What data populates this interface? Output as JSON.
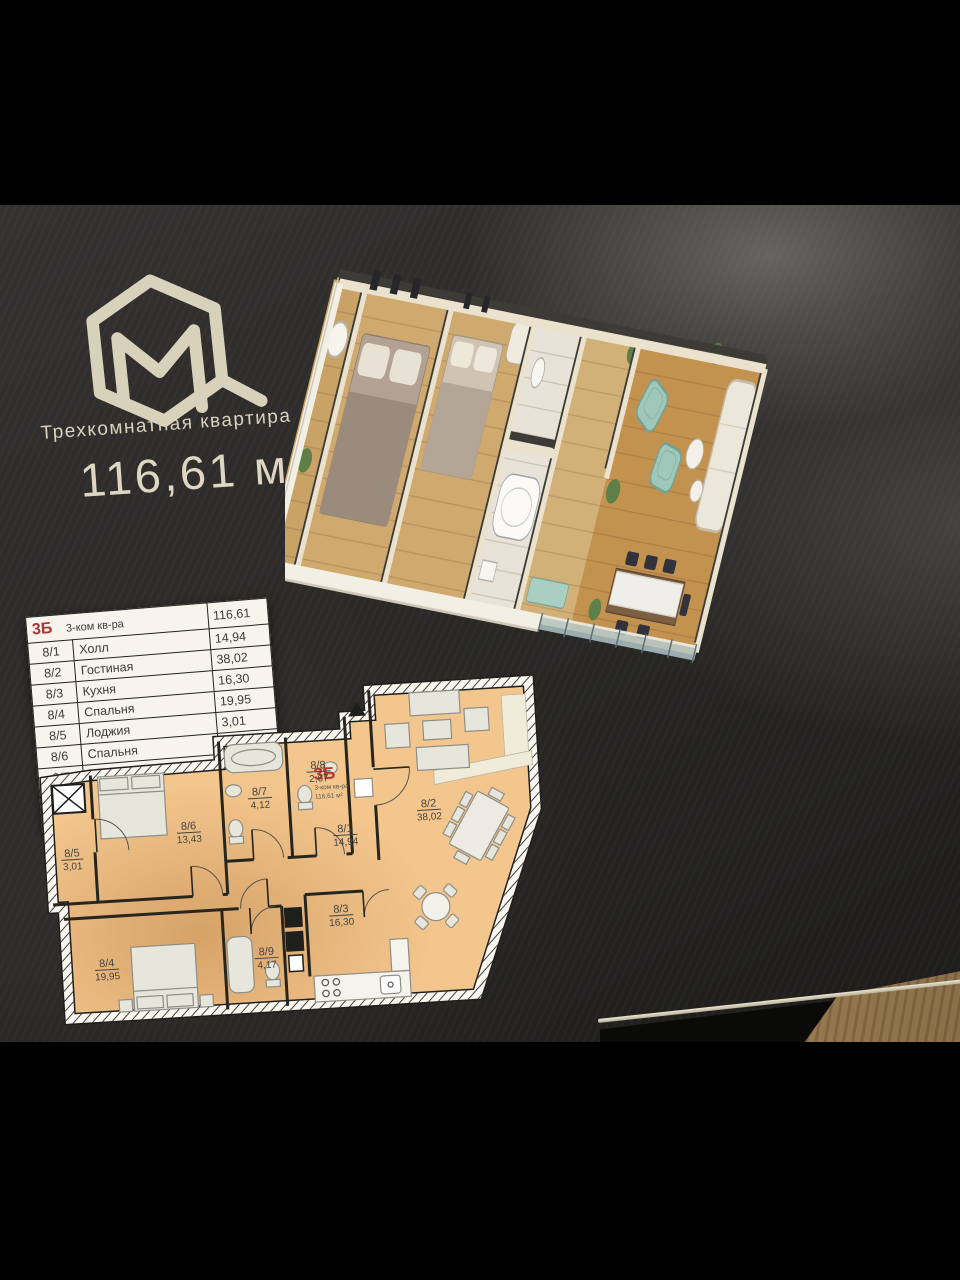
{
  "brand": {
    "mark": "М"
  },
  "header": {
    "subtitle": "Трехкомнатная квартира",
    "area": "116,61 м2"
  },
  "table": {
    "header": {
      "unit": "3Б",
      "type": "3-ком кв-ра",
      "total": "116,61"
    },
    "rows": [
      {
        "num": "8/1",
        "name": "Холл",
        "area": "14,94"
      },
      {
        "num": "8/2",
        "name": "Гостиная",
        "area": "38,02"
      },
      {
        "num": "8/3",
        "name": "Кухня",
        "area": "16,30"
      },
      {
        "num": "8/4",
        "name": "Спальня",
        "area": "19,95"
      },
      {
        "num": "8/5",
        "name": "Лоджия",
        "area": "3,01"
      },
      {
        "num": "8/6",
        "name": "Спальня",
        "area": "13,43"
      },
      {
        "num": "8/7",
        "name": "Ванная",
        "area": "4,12"
      },
      {
        "num": "8/8",
        "name": "С/у",
        "area": "2,67"
      },
      {
        "num": "8/9",
        "name": "Ванная",
        "area": "4,17"
      }
    ]
  },
  "floorplan": {
    "unit": "3Б",
    "unit_type": "3-ком кв-ра",
    "unit_area": "116,61 м²",
    "rooms": [
      {
        "id": "8/1",
        "area": "14,94"
      },
      {
        "id": "8/2",
        "area": "38,02"
      },
      {
        "id": "8/3",
        "area": "16,30"
      },
      {
        "id": "8/4",
        "area": "19,95"
      },
      {
        "id": "8/5",
        "area": "3,01"
      },
      {
        "id": "8/6",
        "area": "13,43"
      },
      {
        "id": "8/7",
        "area": "4,12"
      },
      {
        "id": "8/8",
        "area": "2,67"
      },
      {
        "id": "8/9",
        "area": "4,17"
      }
    ]
  },
  "colors": {
    "accent_red": "#b5382f",
    "plan_fill": "#f3c68e",
    "poster_bg": "#232220",
    "cream": "#d9d3bd"
  }
}
